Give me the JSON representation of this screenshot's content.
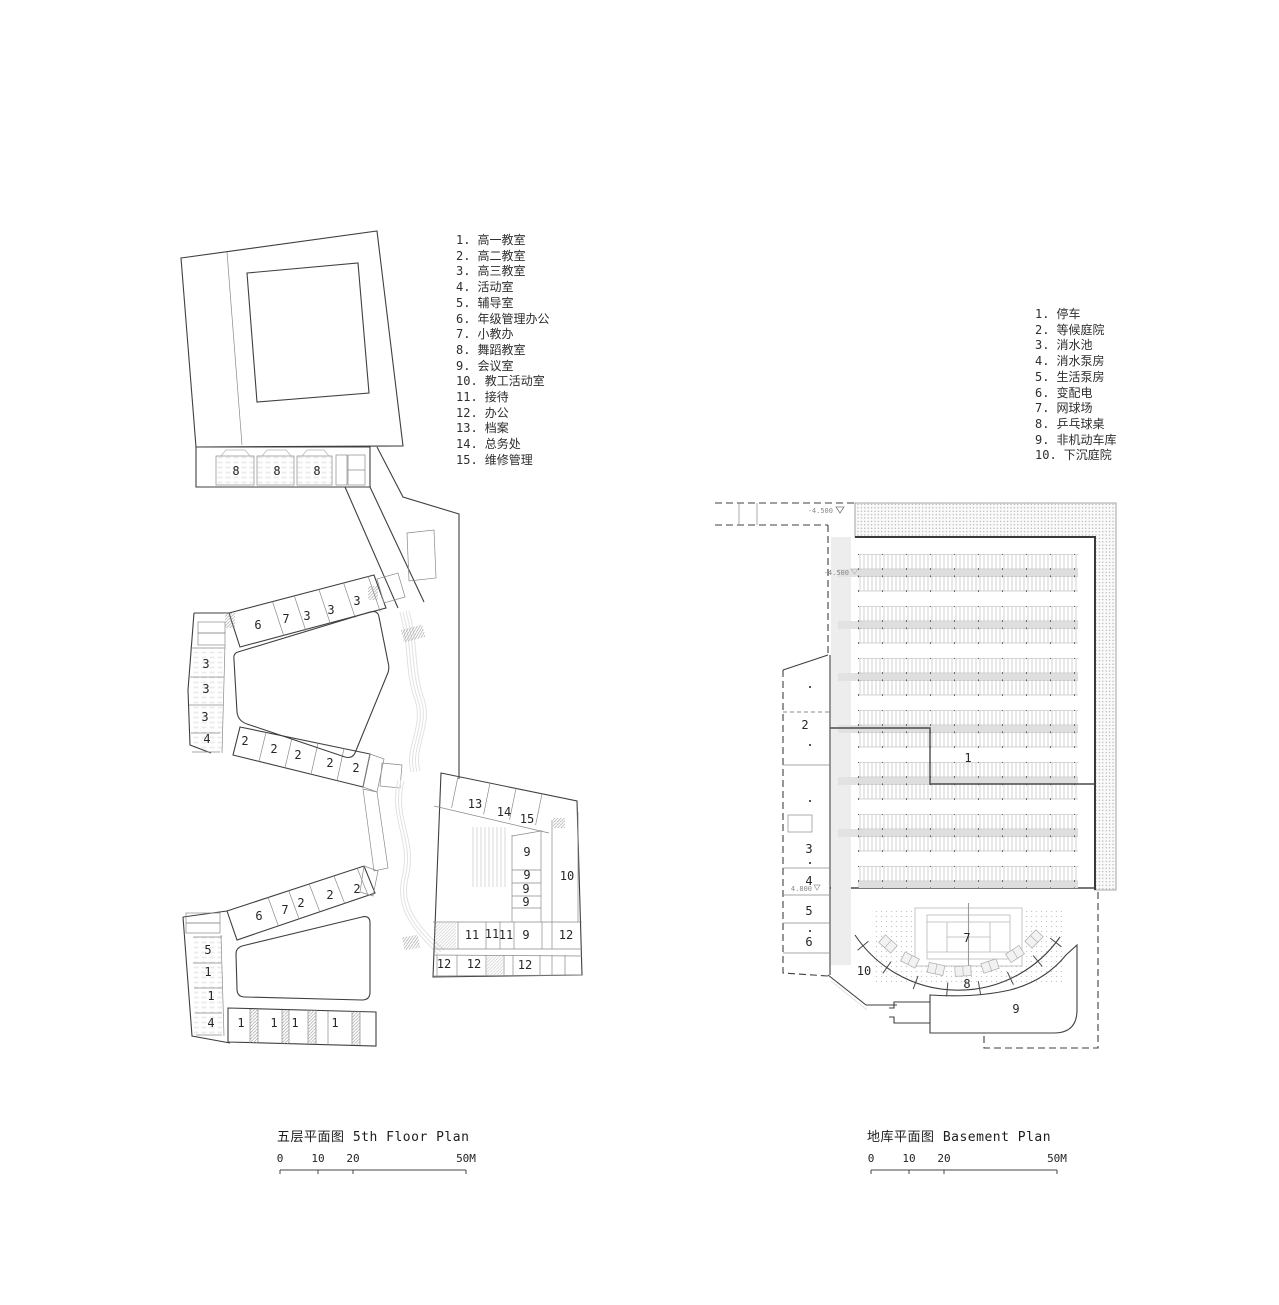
{
  "left_plan": {
    "caption": "五层平面图 5th Floor Plan",
    "legend": [
      {
        "n": "1.",
        "t": "高一教室"
      },
      {
        "n": "2.",
        "t": "高二教室"
      },
      {
        "n": "3.",
        "t": "高三教室"
      },
      {
        "n": "4.",
        "t": "活动室"
      },
      {
        "n": "5.",
        "t": "辅导室"
      },
      {
        "n": "6.",
        "t": "年级管理办公"
      },
      {
        "n": "7.",
        "t": "小教办"
      },
      {
        "n": "8.",
        "t": "舞蹈教室"
      },
      {
        "n": "9.",
        "t": "会议室"
      },
      {
        "n": "10.",
        "t": "教工活动室"
      },
      {
        "n": "11.",
        "t": "接待"
      },
      {
        "n": "12.",
        "t": "办公"
      },
      {
        "n": "13.",
        "t": "档案"
      },
      {
        "n": "14.",
        "t": "总务处"
      },
      {
        "n": "15.",
        "t": "维修管理"
      }
    ],
    "room_labels": [
      {
        "t": "8",
        "x": 236,
        "y": 471
      },
      {
        "t": "8",
        "x": 277,
        "y": 471
      },
      {
        "t": "8",
        "x": 317,
        "y": 471
      },
      {
        "t": "6",
        "x": 258,
        "y": 625
      },
      {
        "t": "7",
        "x": 286,
        "y": 619
      },
      {
        "t": "3",
        "x": 307,
        "y": 616
      },
      {
        "t": "3",
        "x": 331,
        "y": 610
      },
      {
        "t": "3",
        "x": 357,
        "y": 601
      },
      {
        "t": "3",
        "x": 206,
        "y": 664
      },
      {
        "t": "3",
        "x": 206,
        "y": 689
      },
      {
        "t": "3",
        "x": 205,
        "y": 717
      },
      {
        "t": "4",
        "x": 207,
        "y": 739
      },
      {
        "t": "2",
        "x": 245,
        "y": 741
      },
      {
        "t": "2",
        "x": 274,
        "y": 749
      },
      {
        "t": "2",
        "x": 298,
        "y": 755
      },
      {
        "t": "2",
        "x": 330,
        "y": 763
      },
      {
        "t": "2",
        "x": 356,
        "y": 768
      },
      {
        "t": "13",
        "x": 475,
        "y": 804
      },
      {
        "t": "14",
        "x": 504,
        "y": 812
      },
      {
        "t": "15",
        "x": 527,
        "y": 819
      },
      {
        "t": "9",
        "x": 527,
        "y": 852
      },
      {
        "t": "9",
        "x": 527,
        "y": 875
      },
      {
        "t": "9",
        "x": 526,
        "y": 889
      },
      {
        "t": "9",
        "x": 526,
        "y": 902
      },
      {
        "t": "10",
        "x": 567,
        "y": 876
      },
      {
        "t": "11",
        "x": 472,
        "y": 935
      },
      {
        "t": "11",
        "x": 492,
        "y": 934
      },
      {
        "t": "11",
        "x": 506,
        "y": 935
      },
      {
        "t": "9",
        "x": 526,
        "y": 935
      },
      {
        "t": "12",
        "x": 566,
        "y": 935
      },
      {
        "t": "12",
        "x": 444,
        "y": 964
      },
      {
        "t": "12",
        "x": 474,
        "y": 964
      },
      {
        "t": "12",
        "x": 525,
        "y": 965
      },
      {
        "t": "6",
        "x": 259,
        "y": 916
      },
      {
        "t": "7",
        "x": 285,
        "y": 910
      },
      {
        "t": "2",
        "x": 301,
        "y": 903
      },
      {
        "t": "2",
        "x": 330,
        "y": 895
      },
      {
        "t": "2",
        "x": 357,
        "y": 889
      },
      {
        "t": "5",
        "x": 208,
        "y": 950
      },
      {
        "t": "1",
        "x": 208,
        "y": 972
      },
      {
        "t": "1",
        "x": 211,
        "y": 996
      },
      {
        "t": "4",
        "x": 211,
        "y": 1023
      },
      {
        "t": "1",
        "x": 241,
        "y": 1023
      },
      {
        "t": "1",
        "x": 274,
        "y": 1023
      },
      {
        "t": "1",
        "x": 295,
        "y": 1023
      },
      {
        "t": "1",
        "x": 335,
        "y": 1023
      }
    ],
    "scale_bar": {
      "x1": 280,
      "x2": 466,
      "y_line": 1170,
      "y_text": 1162,
      "marks": [
        {
          "t": "0",
          "x": 280
        },
        {
          "t": "10",
          "x": 318
        },
        {
          "t": "20",
          "x": 353
        },
        {
          "t": "50M",
          "x": 466
        }
      ]
    }
  },
  "right_plan": {
    "caption": "地库平面图 Basement Plan",
    "legend": [
      {
        "n": "1.",
        "t": "停车"
      },
      {
        "n": "2.",
        "t": "等候庭院"
      },
      {
        "n": "3.",
        "t": "消水池"
      },
      {
        "n": "4.",
        "t": "消水泵房"
      },
      {
        "n": "5.",
        "t": "生活泵房"
      },
      {
        "n": "6.",
        "t": "变配电"
      },
      {
        "n": "7.",
        "t": "网球场"
      },
      {
        "n": "8.",
        "t": "乒乓球桌"
      },
      {
        "n": "9.",
        "t": "非机动车库"
      },
      {
        "n": "10.",
        "t": "下沉庭院"
      }
    ],
    "room_labels": [
      {
        "t": "1",
        "x": 968,
        "y": 758
      },
      {
        "t": "2",
        "x": 805,
        "y": 725
      },
      {
        "t": "3",
        "x": 809,
        "y": 849
      },
      {
        "t": "4",
        "x": 809,
        "y": 881
      },
      {
        "t": "5",
        "x": 809,
        "y": 911
      },
      {
        "t": "6",
        "x": 809,
        "y": 942
      },
      {
        "t": "7",
        "x": 967,
        "y": 938
      },
      {
        "t": "8",
        "x": 967,
        "y": 984
      },
      {
        "t": "9",
        "x": 1016,
        "y": 1009
      },
      {
        "t": "10",
        "x": 864,
        "y": 971
      }
    ],
    "annotations": [
      {
        "t": "-4.500",
        "x": 833,
        "y": 513
      },
      {
        "t": "-4.500",
        "x": 849,
        "y": 575
      },
      {
        "t": "4.800",
        "x": 812,
        "y": 891
      }
    ],
    "scale_bar": {
      "x1": 871,
      "x2": 1057,
      "y_line": 1170,
      "y_text": 1162,
      "marks": [
        {
          "t": "0",
          "x": 871
        },
        {
          "t": "10",
          "x": 909
        },
        {
          "t": "20",
          "x": 944
        },
        {
          "t": "50M",
          "x": 1057
        }
      ]
    }
  }
}
